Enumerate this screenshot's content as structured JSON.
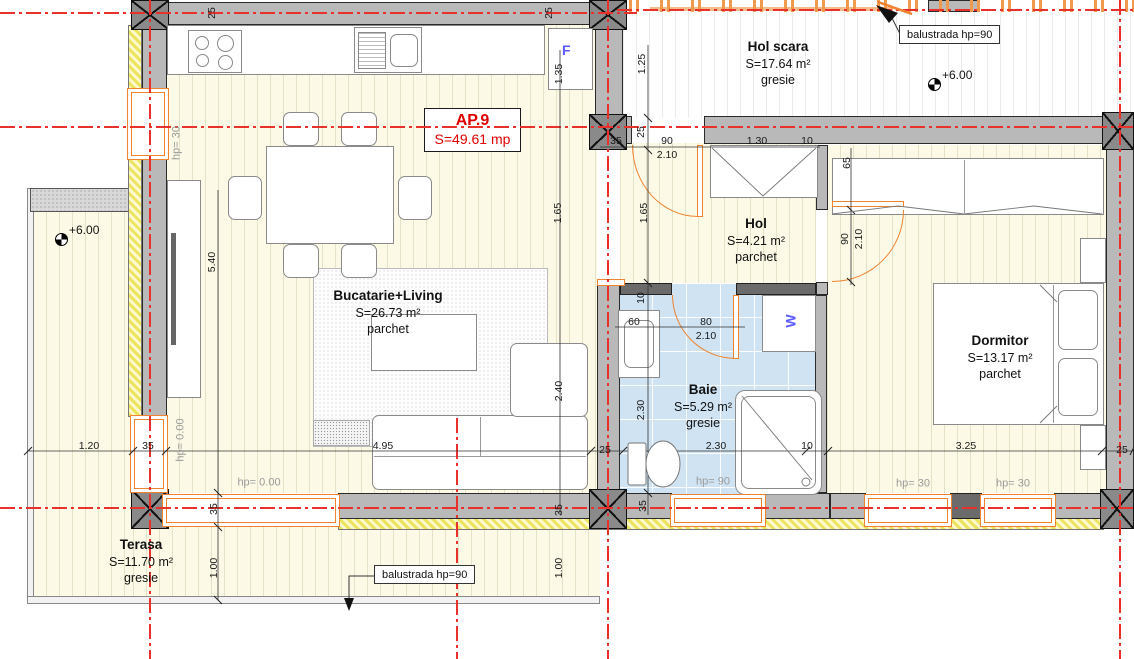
{
  "plan": {
    "apartment": {
      "code": "AP.9",
      "area": "S=49.61 mp"
    },
    "rooms": {
      "hol_scara": {
        "name": "Hol scara",
        "area": "S=17.64 m²",
        "floor": "gresie"
      },
      "bucatarie_living": {
        "name": "Bucatarie+Living",
        "area": "S=26.73 m²",
        "floor": "parchet"
      },
      "hol": {
        "name": "Hol",
        "area": "S=4.21 m²",
        "floor": "parchet"
      },
      "baie": {
        "name": "Baie",
        "area": "S=5.29 m²",
        "floor": "gresie"
      },
      "dormitor": {
        "name": "Dormitor",
        "area": "S=13.17 m²",
        "floor": "parchet"
      },
      "terasa": {
        "name": "Terasa",
        "area": "S=11.70 m²",
        "floor": "gresie"
      }
    },
    "callouts": {
      "balustrade_top": "balustrada hp=90",
      "balustrade_bottom": "balustrada hp=90"
    },
    "levels": {
      "terasa": "+6.00",
      "hol_scara": "+6.00"
    },
    "appliances": {
      "fridge": "F",
      "washer": "W"
    },
    "colors": {
      "axis_red": "#e8312a",
      "joinery_orange": "#ef8330",
      "baie_tile": "#cfe3f2",
      "label_red": "#e00000",
      "dim_gray": "#999999"
    },
    "dimensions": [
      {
        "text": "25",
        "x": 212,
        "y": 13,
        "v": true
      },
      {
        "text": "25",
        "x": 549,
        "y": 13,
        "v": true
      },
      {
        "text": "1.35",
        "x": 559,
        "y": 74,
        "v": true
      },
      {
        "text": "1.25",
        "x": 642,
        "y": 64,
        "v": true
      },
      {
        "text": "25",
        "x": 641,
        "y": 132,
        "v": true
      },
      {
        "text": "hp= 30",
        "x": 177,
        "y": 143,
        "v": true,
        "g": true
      },
      {
        "text": "35",
        "x": 616,
        "y": 141
      },
      {
        "text": "90",
        "x": 667,
        "y": 141
      },
      {
        "text": "2.10",
        "x": 667,
        "y": 155
      },
      {
        "text": "1.30",
        "x": 757,
        "y": 141
      },
      {
        "text": "10",
        "x": 807,
        "y": 141
      },
      {
        "text": "65",
        "x": 847,
        "y": 163,
        "v": true
      },
      {
        "text": "1.65",
        "x": 558,
        "y": 213,
        "v": true
      },
      {
        "text": "1.65",
        "x": 644,
        "y": 213,
        "v": true
      },
      {
        "text": "90",
        "x": 845,
        "y": 239,
        "v": true
      },
      {
        "text": "2.10",
        "x": 859,
        "y": 239,
        "v": true
      },
      {
        "text": "5.40",
        "x": 212,
        "y": 262,
        "v": true
      },
      {
        "text": "10",
        "x": 641,
        "y": 298,
        "v": true
      },
      {
        "text": "60",
        "x": 634,
        "y": 322
      },
      {
        "text": "80",
        "x": 706,
        "y": 322
      },
      {
        "text": "2.10",
        "x": 706,
        "y": 336
      },
      {
        "text": "2.40",
        "x": 559,
        "y": 391,
        "v": true
      },
      {
        "text": "2.30",
        "x": 641,
        "y": 410,
        "v": true
      },
      {
        "text": "1.20",
        "x": 89,
        "y": 446
      },
      {
        "text": "35",
        "x": 148,
        "y": 446
      },
      {
        "text": "hp= 0.00",
        "x": 181,
        "y": 440,
        "v": true,
        "g": true
      },
      {
        "text": "4.95",
        "x": 383,
        "y": 446
      },
      {
        "text": "25",
        "x": 605,
        "y": 450
      },
      {
        "text": "2.30",
        "x": 716,
        "y": 446
      },
      {
        "text": "10",
        "x": 807,
        "y": 446
      },
      {
        "text": "3.25",
        "x": 966,
        "y": 446
      },
      {
        "text": "25",
        "x": 1122,
        "y": 450
      },
      {
        "text": "hp= 0.00",
        "x": 259,
        "y": 483,
        "g": true
      },
      {
        "text": "hp= 90",
        "x": 713,
        "y": 482,
        "g": true
      },
      {
        "text": "hp= 30",
        "x": 913,
        "y": 484,
        "g": true
      },
      {
        "text": "hp= 30",
        "x": 1013,
        "y": 484,
        "g": true
      },
      {
        "text": "35",
        "x": 214,
        "y": 509,
        "v": true
      },
      {
        "text": "35",
        "x": 559,
        "y": 510,
        "v": true
      },
      {
        "text": "35",
        "x": 643,
        "y": 506,
        "v": true
      },
      {
        "text": "1.00",
        "x": 214,
        "y": 568,
        "v": true
      },
      {
        "text": "1.00",
        "x": 559,
        "y": 568,
        "v": true
      }
    ]
  }
}
